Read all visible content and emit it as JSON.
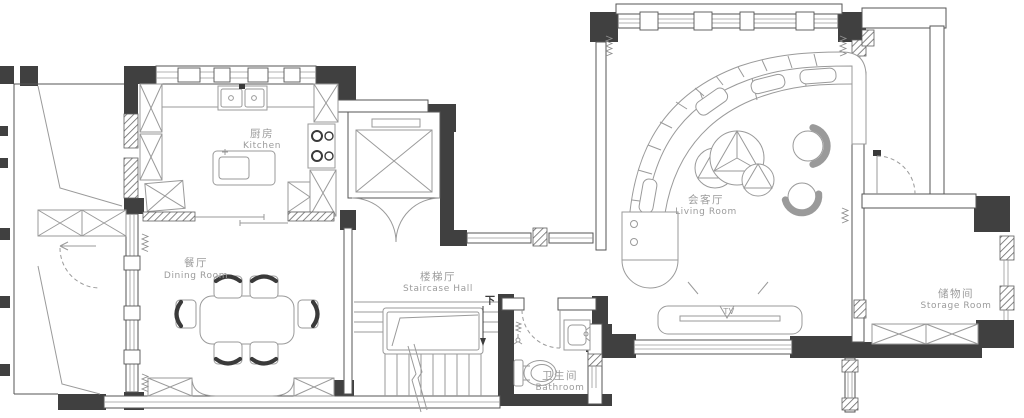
{
  "colors": {
    "wall": "#404040",
    "wallline": "#565656",
    "winline": "#9a9a9a",
    "furn": "#9a9a9a",
    "label": "#9b9b9b",
    "background": "#ffffff"
  },
  "rooms": {
    "kitchen": {
      "zh": "厨房",
      "en": "Kitchen"
    },
    "dining": {
      "zh": "餐厅",
      "en": "Dining Room"
    },
    "staircase": {
      "zh": "楼梯厅",
      "en": "Staircase Hall"
    },
    "living": {
      "zh": "会客厅",
      "en": "Living Room"
    },
    "storage": {
      "zh": "储物间",
      "en": "Storage Room"
    },
    "bathroom": {
      "zh": "卫生间",
      "en": "Bathroom"
    }
  },
  "annotations": {
    "stairs_down": "下",
    "tv": "TV"
  }
}
